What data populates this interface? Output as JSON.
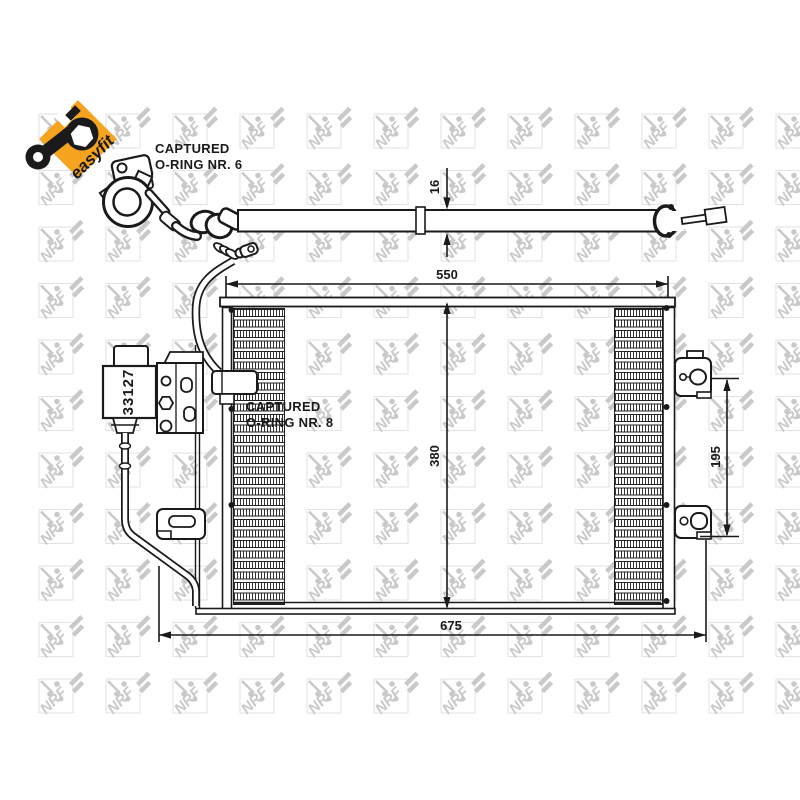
{
  "product": {
    "watermark_text": "NRF",
    "badge_text": "easyfit",
    "part_number": "33127"
  },
  "labels": {
    "oring6_line1": "CAPTURED",
    "oring6_line2": "O-RING NR. 6",
    "oring8_line1": "CAPTURED",
    "oring8_line2": "O-RING NR. 8"
  },
  "dimensions": {
    "tube_height": "16",
    "upper_width": "550",
    "core_height": "380",
    "overall_width": "675",
    "bracket_spacing": "195"
  },
  "colors": {
    "badge_orange": "#F6A31F",
    "line_black": "#1a1a1a",
    "watermark_gray": "#c9c9c9",
    "watermark_box": "#e2e2e2"
  }
}
